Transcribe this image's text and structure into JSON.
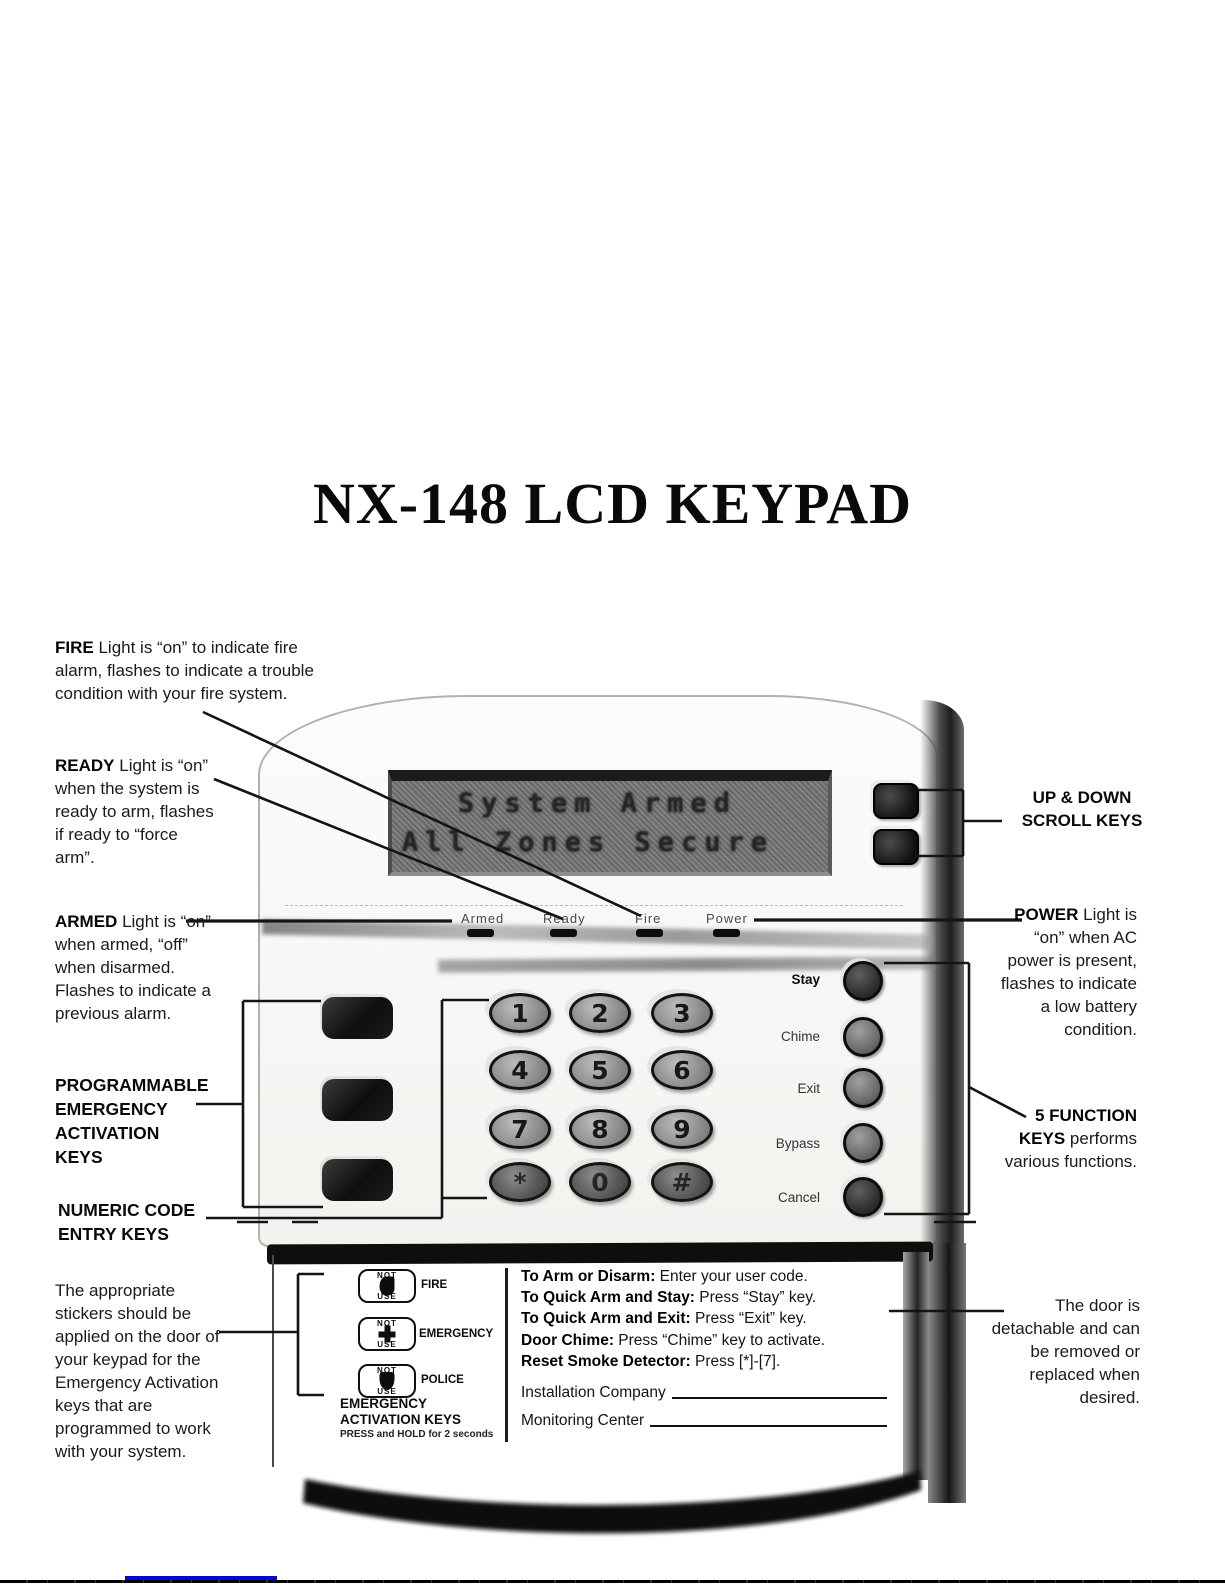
{
  "page": {
    "title": "NX-148 LCD KEYPAD"
  },
  "annotations": {
    "fire": {
      "lead": "FIRE",
      "text": " Light is “on” to indicate fire alarm, flashes to indicate a trouble condition with your fire system."
    },
    "ready": {
      "lead": "READY",
      "text": " Light is “on” when the system is ready to arm, flashes if ready to “force arm”."
    },
    "armed": {
      "lead": "ARMED",
      "text": " Light is “on” when armed, “off” when disarmed. Flashes to indicate a previous alarm."
    },
    "programmable": {
      "line1": "PROGRAMMABLE",
      "line2": "EMERGENCY",
      "line3": "ACTIVATION",
      "line4": "KEYS"
    },
    "numeric": {
      "line1": "NUMERIC CODE",
      "line2": "ENTRY KEYS"
    },
    "stickers": "The appropriate stickers should be applied on the door of your keypad for the Emergency Activation keys that are programmed to work with your system.",
    "scroll": {
      "line1": "UP & DOWN",
      "line2": "SCROLL KEYS"
    },
    "power": {
      "lead": "POWER",
      "text": " Light is “on” when AC power is present, flashes to indicate a low battery condition."
    },
    "function_keys": {
      "lead": "5 FUNCTION KEYS",
      "text": " performs various functions."
    },
    "door": "The door is detachable and can be removed or replaced when desired."
  },
  "keypad": {
    "lcd": {
      "line1": "System Armed",
      "line2": "All Zones Secure"
    },
    "indicators": [
      "Armed",
      "Ready",
      "Fire",
      "Power"
    ],
    "numeric_keys": [
      "1",
      "2",
      "3",
      "4",
      "5",
      "6",
      "7",
      "8",
      "9",
      "*",
      "0",
      "#"
    ],
    "function_keys": [
      "Stay",
      "Chime",
      "Exit",
      "Bypass",
      "Cancel"
    ],
    "scroll_keys": [
      "up-scroll-key",
      "down-scroll-key"
    ]
  },
  "door": {
    "stickers": {
      "not_text": "NOT",
      "use_text": "USE",
      "items": [
        {
          "label": "FIRE"
        },
        {
          "label": "EMERGENCY"
        },
        {
          "label": "POLICE"
        }
      ]
    },
    "caption": {
      "line1": "EMERGENCY",
      "line2": "ACTIVATION KEYS",
      "line3": "PRESS and HOLD for 2 seconds"
    },
    "instructions": [
      {
        "label": "To Arm or Disarm:",
        "text": " Enter your user code."
      },
      {
        "label": "To Quick Arm and Stay:",
        "text": " Press “Stay” key."
      },
      {
        "label": "To Quick Arm and Exit:",
        "text": " Press “Exit” key."
      },
      {
        "label": "Door Chime:",
        "text": " Press “Chime” key to activate."
      },
      {
        "label": "Reset Smoke Detector:",
        "text": " Press [*]-[7]."
      }
    ],
    "fields": [
      {
        "label": "Installation Company"
      },
      {
        "label": "Monitoring Center"
      }
    ]
  }
}
